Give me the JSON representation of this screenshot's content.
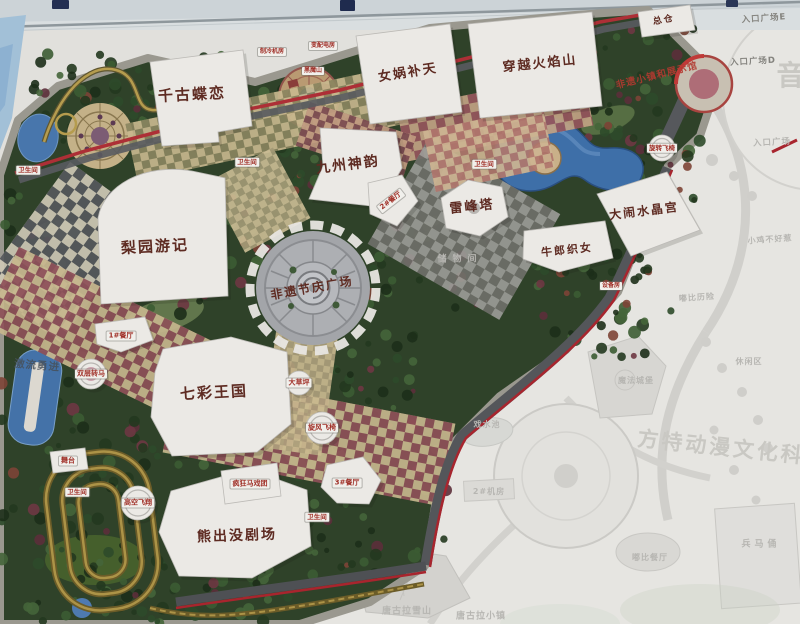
{
  "map": {
    "kind": "theme-park guide map photo",
    "accent_colors": {
      "park_green": "#2f4229",
      "border_road_red": "#ad2f36",
      "water_blue": "#3e6fa8",
      "building_white": "#ebe9e5",
      "label_brown": "#5e2b22",
      "sign_red": "#a03028",
      "faded_gray": "#b7b6b2"
    }
  },
  "labels": [
    {
      "n": "label-qiangu-dielian",
      "text": "千古蝶恋",
      "x": 192,
      "y": 95,
      "k": "bld",
      "s": 15,
      "r": -3
    },
    {
      "n": "label-nvwa-butian",
      "text": "女娲补天",
      "x": 408,
      "y": 73,
      "k": "bld",
      "s": 13,
      "r": -9
    },
    {
      "n": "label-chuanyue-huoyanshan",
      "text": "穿越火焰山",
      "x": 540,
      "y": 64,
      "k": "bld",
      "s": 13,
      "r": -6
    },
    {
      "n": "label-zongcang",
      "text": "总仓",
      "x": 664,
      "y": 21,
      "k": "bld",
      "s": 9,
      "r": -10
    },
    {
      "n": "label-jiuzhou-shenyun",
      "text": "九州神韵",
      "x": 348,
      "y": 165,
      "k": "bld",
      "s": 14,
      "r": -7
    },
    {
      "n": "label-leifengta",
      "text": "雷峰塔",
      "x": 472,
      "y": 207,
      "k": "bld",
      "s": 13,
      "r": -6
    },
    {
      "n": "label-danao-shuijinggong",
      "text": "大闹水晶宫",
      "x": 644,
      "y": 211,
      "k": "bld",
      "s": 12,
      "r": -7
    },
    {
      "n": "label-niulang-zhinv",
      "text": "牛郎织女",
      "x": 567,
      "y": 250,
      "k": "bld",
      "s": 11,
      "r": -6
    },
    {
      "n": "label-liyuan-youji",
      "text": "梨园游记",
      "x": 155,
      "y": 247,
      "k": "bld",
      "s": 15,
      "r": -3
    },
    {
      "n": "label-feiyi-jieqing-plaza",
      "text": "非遗节庆广场",
      "x": 312,
      "y": 288,
      "k": "bld",
      "s": 12,
      "r": -10
    },
    {
      "n": "label-qicai-wangguo",
      "text": "七彩王国",
      "x": 214,
      "y": 393,
      "k": "bld",
      "s": 15,
      "r": -3
    },
    {
      "n": "label-xiongchumo-theater",
      "text": "熊出没剧场",
      "x": 237,
      "y": 536,
      "k": "bld",
      "s": 14,
      "r": -2
    },
    {
      "n": "label-restaurant-1",
      "text": "1#餐厅",
      "x": 121,
      "y": 336,
      "k": "sign",
      "s": 7
    },
    {
      "n": "label-restaurant-2",
      "text": "2#餐厅",
      "x": 391,
      "y": 201,
      "k": "sign",
      "s": 7,
      "r": -38
    },
    {
      "n": "label-restaurant-3",
      "text": "3#餐厅",
      "x": 347,
      "y": 483,
      "k": "sign",
      "s": 7
    },
    {
      "n": "label-toilet-west",
      "text": "卫生间",
      "x": 28,
      "y": 170,
      "k": "sign",
      "s": 6.5
    },
    {
      "n": "label-toilet-north",
      "text": "卫生间",
      "x": 247,
      "y": 162,
      "k": "sign",
      "s": 6.5
    },
    {
      "n": "label-toilet-center",
      "text": "卫生间",
      "x": 484,
      "y": 164,
      "k": "sign",
      "s": 6.5
    },
    {
      "n": "label-toilet-southwest",
      "text": "卫生间",
      "x": 77,
      "y": 492,
      "k": "sign",
      "s": 6.5
    },
    {
      "n": "label-toilet-south",
      "text": "卫生间",
      "x": 317,
      "y": 517,
      "k": "sign",
      "s": 6.5
    },
    {
      "n": "label-stage",
      "text": "舞台",
      "x": 68,
      "y": 461,
      "k": "sign",
      "s": 7
    },
    {
      "n": "label-gaokong-feixiang",
      "text": "高空飞翔",
      "x": 138,
      "y": 503,
      "k": "sign",
      "s": 7
    },
    {
      "n": "label-fengkuang-maxituan",
      "text": "疯狂马戏团",
      "x": 250,
      "y": 484,
      "k": "sign",
      "s": 7
    },
    {
      "n": "label-xuanfeng-feiyi",
      "text": "旋风飞椅",
      "x": 322,
      "y": 428,
      "k": "sign",
      "s": 7
    },
    {
      "n": "label-dacaoping",
      "text": "大草坪",
      "x": 299,
      "y": 383,
      "k": "sign",
      "s": 7
    },
    {
      "n": "label-shuangceng-zhuanma",
      "text": "双层转马",
      "x": 91,
      "y": 374,
      "k": "sign",
      "s": 7
    },
    {
      "n": "label-xuanzhuan-feiyi",
      "text": "旋转飞椅",
      "x": 662,
      "y": 148,
      "k": "sign",
      "s": 6.5
    },
    {
      "n": "label-zhileng-jifang",
      "text": "制冷机房",
      "x": 272,
      "y": 52,
      "k": "sign",
      "s": 6
    },
    {
      "n": "label-bianpeidian-fang",
      "text": "变配电房",
      "x": 323,
      "y": 46,
      "k": "sign",
      "s": 6
    },
    {
      "n": "label-heimoshan",
      "text": "黑魔山",
      "x": 313,
      "y": 71,
      "k": "sign",
      "s": 6
    },
    {
      "n": "label-shebeifang",
      "text": "设备房",
      "x": 611,
      "y": 286,
      "k": "sign",
      "s": 6
    },
    {
      "n": "label-jiliu-yongjin",
      "text": "激流勇进",
      "x": 37,
      "y": 366,
      "k": "water",
      "s": 10.5,
      "r": 5
    },
    {
      "n": "label-feiyi-xiaozhen-banner",
      "text": "非遗小镇和展示馆",
      "x": 657,
      "y": 76,
      "k": "red",
      "s": 9.5,
      "r": -14
    },
    {
      "n": "label-entrance-plaza-e",
      "text": "入口广场E",
      "x": 764,
      "y": 19,
      "k": "entr",
      "s": 8.5,
      "r": -4
    },
    {
      "n": "label-entrance-plaza-d",
      "text": "入口广场D",
      "x": 753,
      "y": 62,
      "k": "entr",
      "s": 8.5,
      "r": -3
    },
    {
      "n": "label-entrance-plaza",
      "text": "入口广场",
      "x": 772,
      "y": 143,
      "k": "fade",
      "s": 8.5,
      "r": -3
    },
    {
      "n": "label-chuwujian",
      "text": "储物间",
      "x": 460,
      "y": 260,
      "k": "fade",
      "s": 9,
      "ls": 6
    },
    {
      "n": "label-xiaoji-buhaore",
      "text": "小鸡不好惹",
      "x": 770,
      "y": 240,
      "k": "fade",
      "s": 8,
      "r": -4
    },
    {
      "n": "label-dubi-lixian",
      "text": "嘟比历险",
      "x": 697,
      "y": 298,
      "k": "fade",
      "s": 8,
      "r": -4
    },
    {
      "n": "label-xiuxianqu",
      "text": "休闲区",
      "x": 749,
      "y": 362,
      "k": "fade",
      "s": 8
    },
    {
      "n": "label-mofa-chengbao",
      "text": "魔法城堡",
      "x": 636,
      "y": 381,
      "k": "fade",
      "s": 8
    },
    {
      "n": "label-xishuichi",
      "text": "戏水池",
      "x": 487,
      "y": 425,
      "k": "fade",
      "s": 8
    },
    {
      "n": "label-jifang-2",
      "text": "2#机房",
      "x": 489,
      "y": 492,
      "k": "fade",
      "s": 8
    },
    {
      "n": "label-dubi-canting",
      "text": "嘟比餐厅",
      "x": 650,
      "y": 558,
      "k": "fade",
      "s": 8
    },
    {
      "n": "label-bingmayong",
      "text": "兵马俑",
      "x": 761,
      "y": 545,
      "k": "fade",
      "s": 9,
      "ls": 4
    },
    {
      "n": "label-tanggula-xueshan",
      "text": "唐古拉雪山",
      "x": 407,
      "y": 612,
      "k": "fade",
      "s": 9
    },
    {
      "n": "label-tanggula-xiaozhen",
      "text": "唐古拉小镇",
      "x": 481,
      "y": 617,
      "k": "fade",
      "s": 9
    },
    {
      "n": "label-watermark-fantawild",
      "text": "方特动漫文化科技",
      "x": 733,
      "y": 449,
      "k": "wm",
      "s": 21,
      "r": 6
    },
    {
      "n": "label-watermark-partial",
      "text": "音",
      "x": 792,
      "y": 76,
      "k": "wm",
      "s": 28
    }
  ]
}
